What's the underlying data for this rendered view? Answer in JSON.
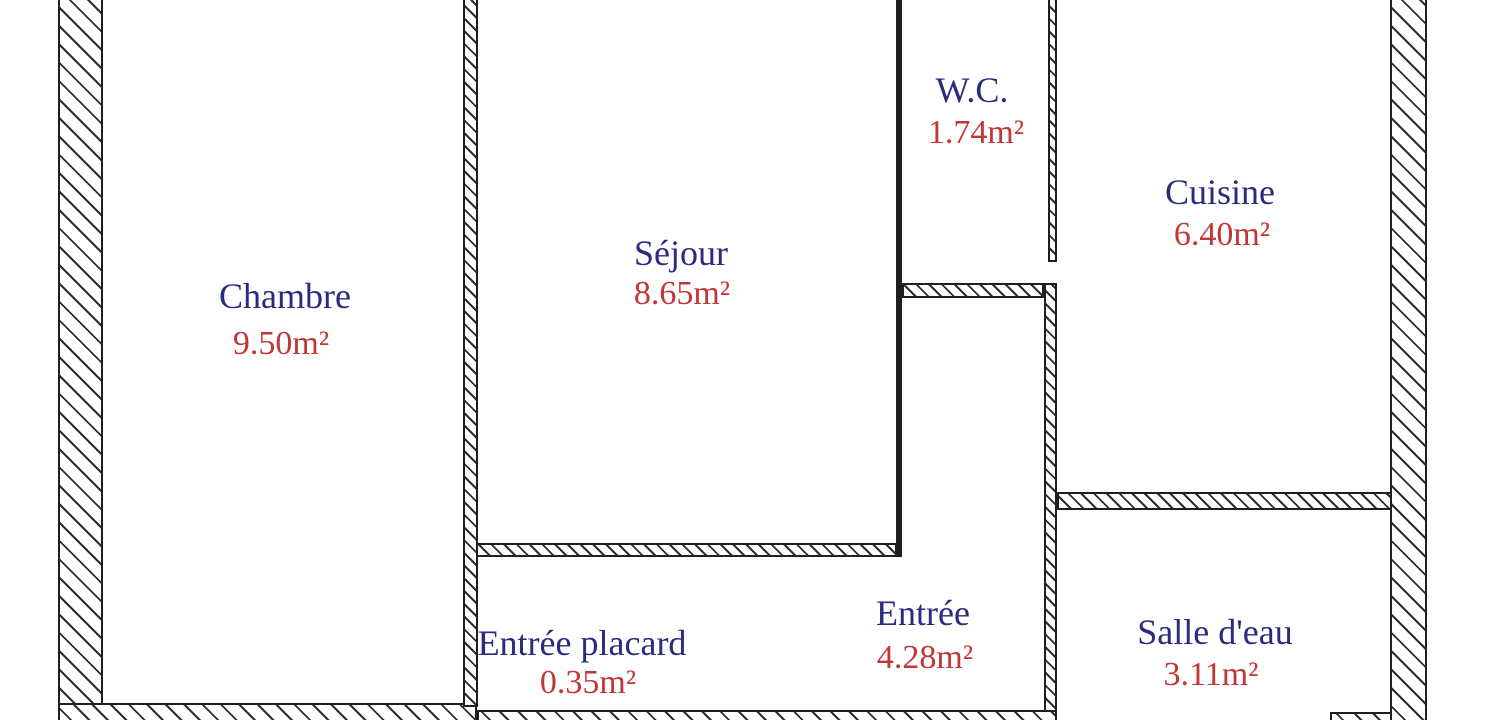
{
  "plan": {
    "type": "floor-plan",
    "rooms": [
      {
        "id": "chambre",
        "name": "Chambre",
        "area": "9.50m²"
      },
      {
        "id": "sejour",
        "name": "Séjour",
        "area": "8.65m²"
      },
      {
        "id": "wc",
        "name": "W.C.",
        "area": "1.74m²"
      },
      {
        "id": "cuisine",
        "name": "Cuisine",
        "area": "6.40m²"
      },
      {
        "id": "entree",
        "name": "Entrée",
        "area": "4.28m²"
      },
      {
        "id": "entree-placard",
        "name": "Entrée placard",
        "area": "0.35m²"
      },
      {
        "id": "salle-deau",
        "name": "Salle d'eau",
        "area": "3.11m²"
      }
    ],
    "colors": {
      "room_name": "#2a2a7e",
      "room_area": "#c23636",
      "wall_line": "#1f1f1f",
      "background": "#ffffff"
    }
  }
}
